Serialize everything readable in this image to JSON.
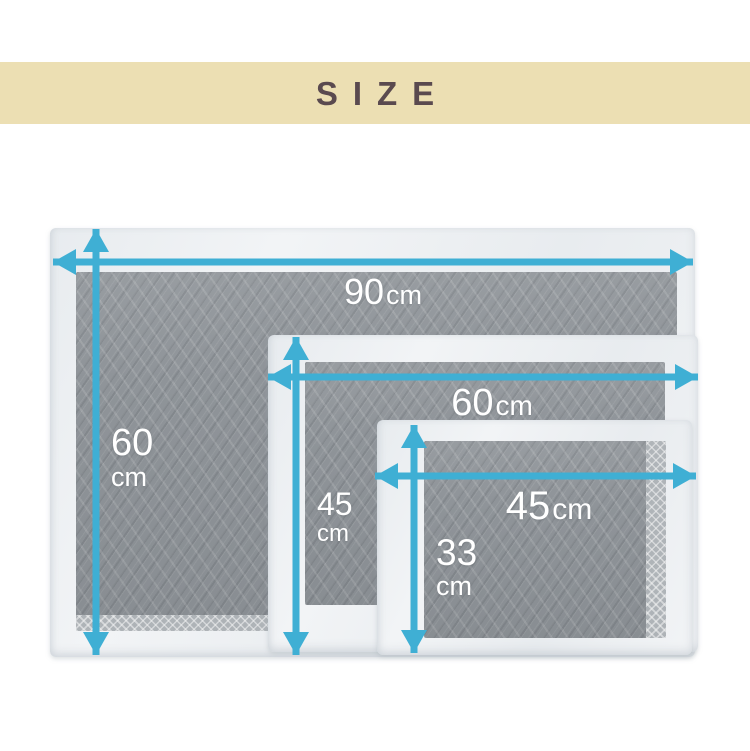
{
  "title_band": {
    "label": "SIZE"
  },
  "colors": {
    "accent": "#3fafd4",
    "band_bg": "#ecdfb3",
    "band_text": "#5a4a4f",
    "pad_white": "#f2f4f6",
    "pad_gray": "#8f9499"
  },
  "pads": [
    {
      "id": "large",
      "width": {
        "value": "90",
        "unit": "cm"
      },
      "height": {
        "value": "60",
        "unit": "cm"
      }
    },
    {
      "id": "medium",
      "width": {
        "value": "60",
        "unit": "cm"
      },
      "height": {
        "value": "45",
        "unit": "cm"
      }
    },
    {
      "id": "small",
      "width": {
        "value": "45",
        "unit": "cm"
      },
      "height": {
        "value": "33",
        "unit": "cm"
      }
    }
  ]
}
